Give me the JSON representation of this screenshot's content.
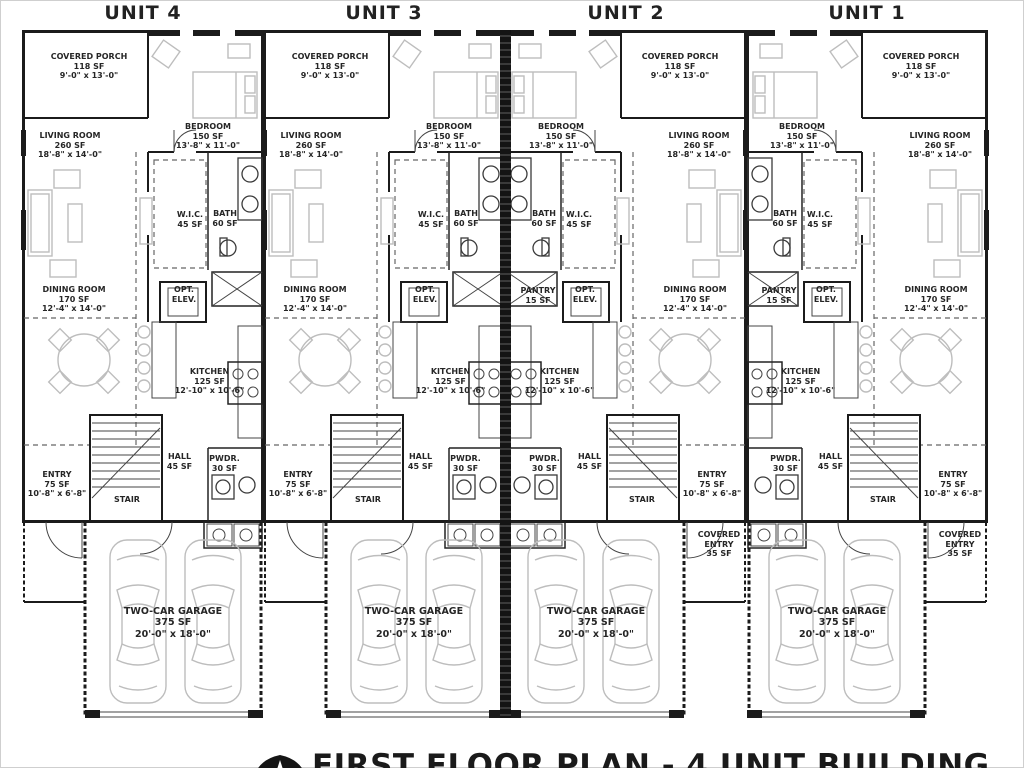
{
  "units": [
    {
      "label": "UNIT 4",
      "mirrored": false
    },
    {
      "label": "UNIT 3",
      "mirrored": false
    },
    {
      "label": "UNIT 2",
      "mirrored": true
    },
    {
      "label": "UNIT 1",
      "mirrored": true
    }
  ],
  "rooms": {
    "covered_porch": {
      "name": "COVERED PORCH",
      "area": "118 SF",
      "dims": "9'-0\" x 13'-0\""
    },
    "bedroom": {
      "name": "BEDROOM",
      "area": "150 SF",
      "dims": "13'-8\" x 11'-0\""
    },
    "living_room": {
      "name": "LIVING ROOM",
      "area": "260 SF",
      "dims": "18'-8\" x 14'-0\""
    },
    "wic": {
      "name": "W.I.C.",
      "area": "45 SF"
    },
    "bath": {
      "name": "BATH",
      "area": "60 SF"
    },
    "opt_elev": {
      "line1": "OPT.",
      "line2": "ELEV."
    },
    "dining_room": {
      "name": "DINING ROOM",
      "area": "170 SF",
      "dims": "12'-4\" x 14'-0\""
    },
    "kitchen": {
      "name": "KITCHEN",
      "area": "125 SF",
      "dims": "12'-10\" x 10'-6\""
    },
    "pantry": {
      "name": "PANTRY",
      "area": "15 SF"
    },
    "hall": {
      "name": "HALL",
      "area": "45 SF"
    },
    "powder": {
      "name": "PWDR.",
      "area": "30 SF"
    },
    "entry": {
      "name": "ENTRY",
      "area": "75 SF",
      "dims": "10'-8\" x 6'-8\""
    },
    "stair": {
      "name": "STAIR"
    },
    "garage": {
      "name": "TWO-CAR GARAGE",
      "area": "375 SF",
      "dims": "20'-0\" x 18'-0\""
    },
    "covered_entry": {
      "name": "COVERED ENTRY",
      "area": "35 SF"
    }
  },
  "footer": {
    "title": "FIRST FLOOR PLAN - 4 UNIT BUILDING"
  },
  "colors": {
    "wall": "#1b1b1b",
    "furniture": "#bdbdbd",
    "text": "#262626"
  }
}
